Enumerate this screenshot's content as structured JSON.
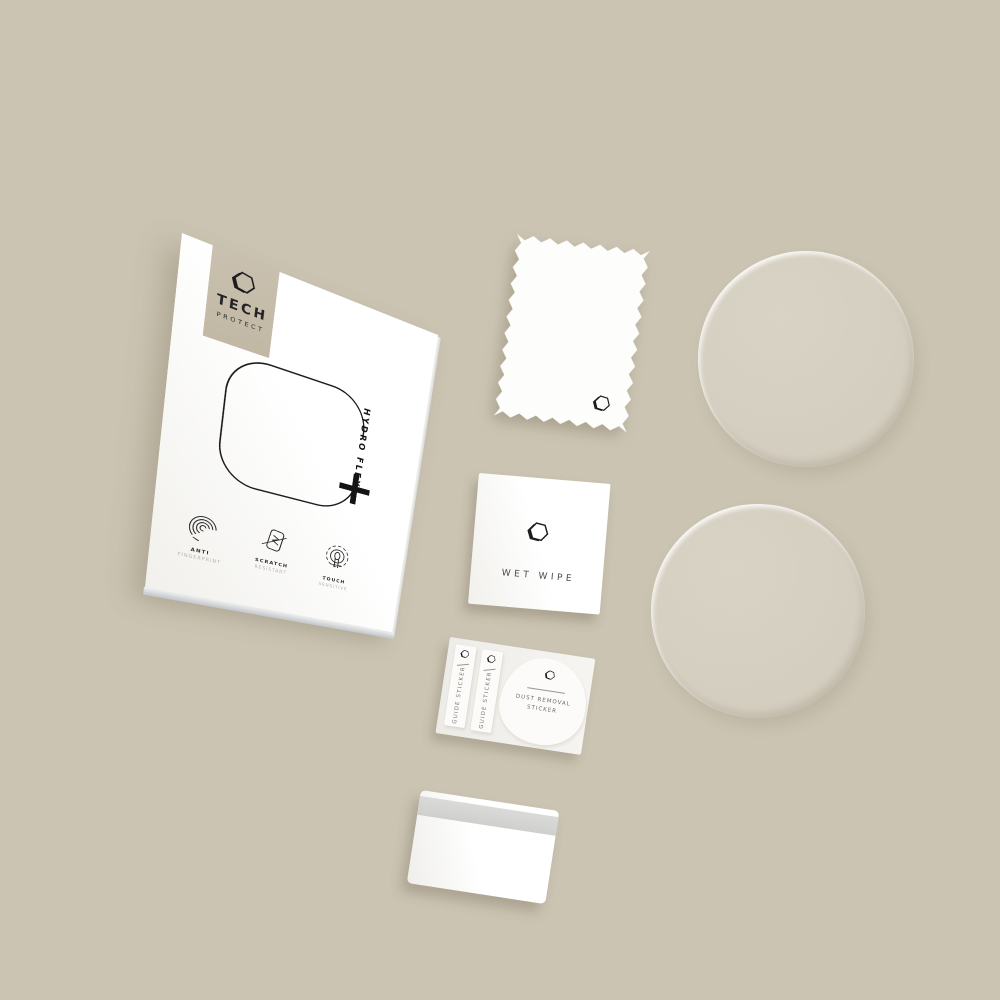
{
  "colors": {
    "background": "#cbc4b2",
    "badge": "#c6bcaa",
    "ink": "#1c1c1c",
    "protector_disc": "#d5cfc1"
  },
  "brand": {
    "logo_icon": "hexagon-3d-icon",
    "line1": "TECH",
    "line2": "PROTECT"
  },
  "box": {
    "product_name": "HYDRO FLEX",
    "plus_symbol": "+",
    "features": [
      {
        "icon": "fingerprint-icon",
        "line1": "ANTI",
        "line2": "FINGERPRINT"
      },
      {
        "icon": "scratch-resistant-icon",
        "line1": "SCRATCH",
        "line2": "RESISTANT"
      },
      {
        "icon": "touch-sensitive-icon",
        "line1": "TOUCH",
        "line2": "SENSITIVE"
      }
    ]
  },
  "wet_wipe": {
    "label": "WET WIPE"
  },
  "sticker_sheet": {
    "guide_sticker_left": "GUIDE STICKER",
    "guide_sticker_right": "GUIDE STICKER",
    "dust_removal_line1": "DUST REMOVAL",
    "dust_removal_line2": "STICKER"
  }
}
